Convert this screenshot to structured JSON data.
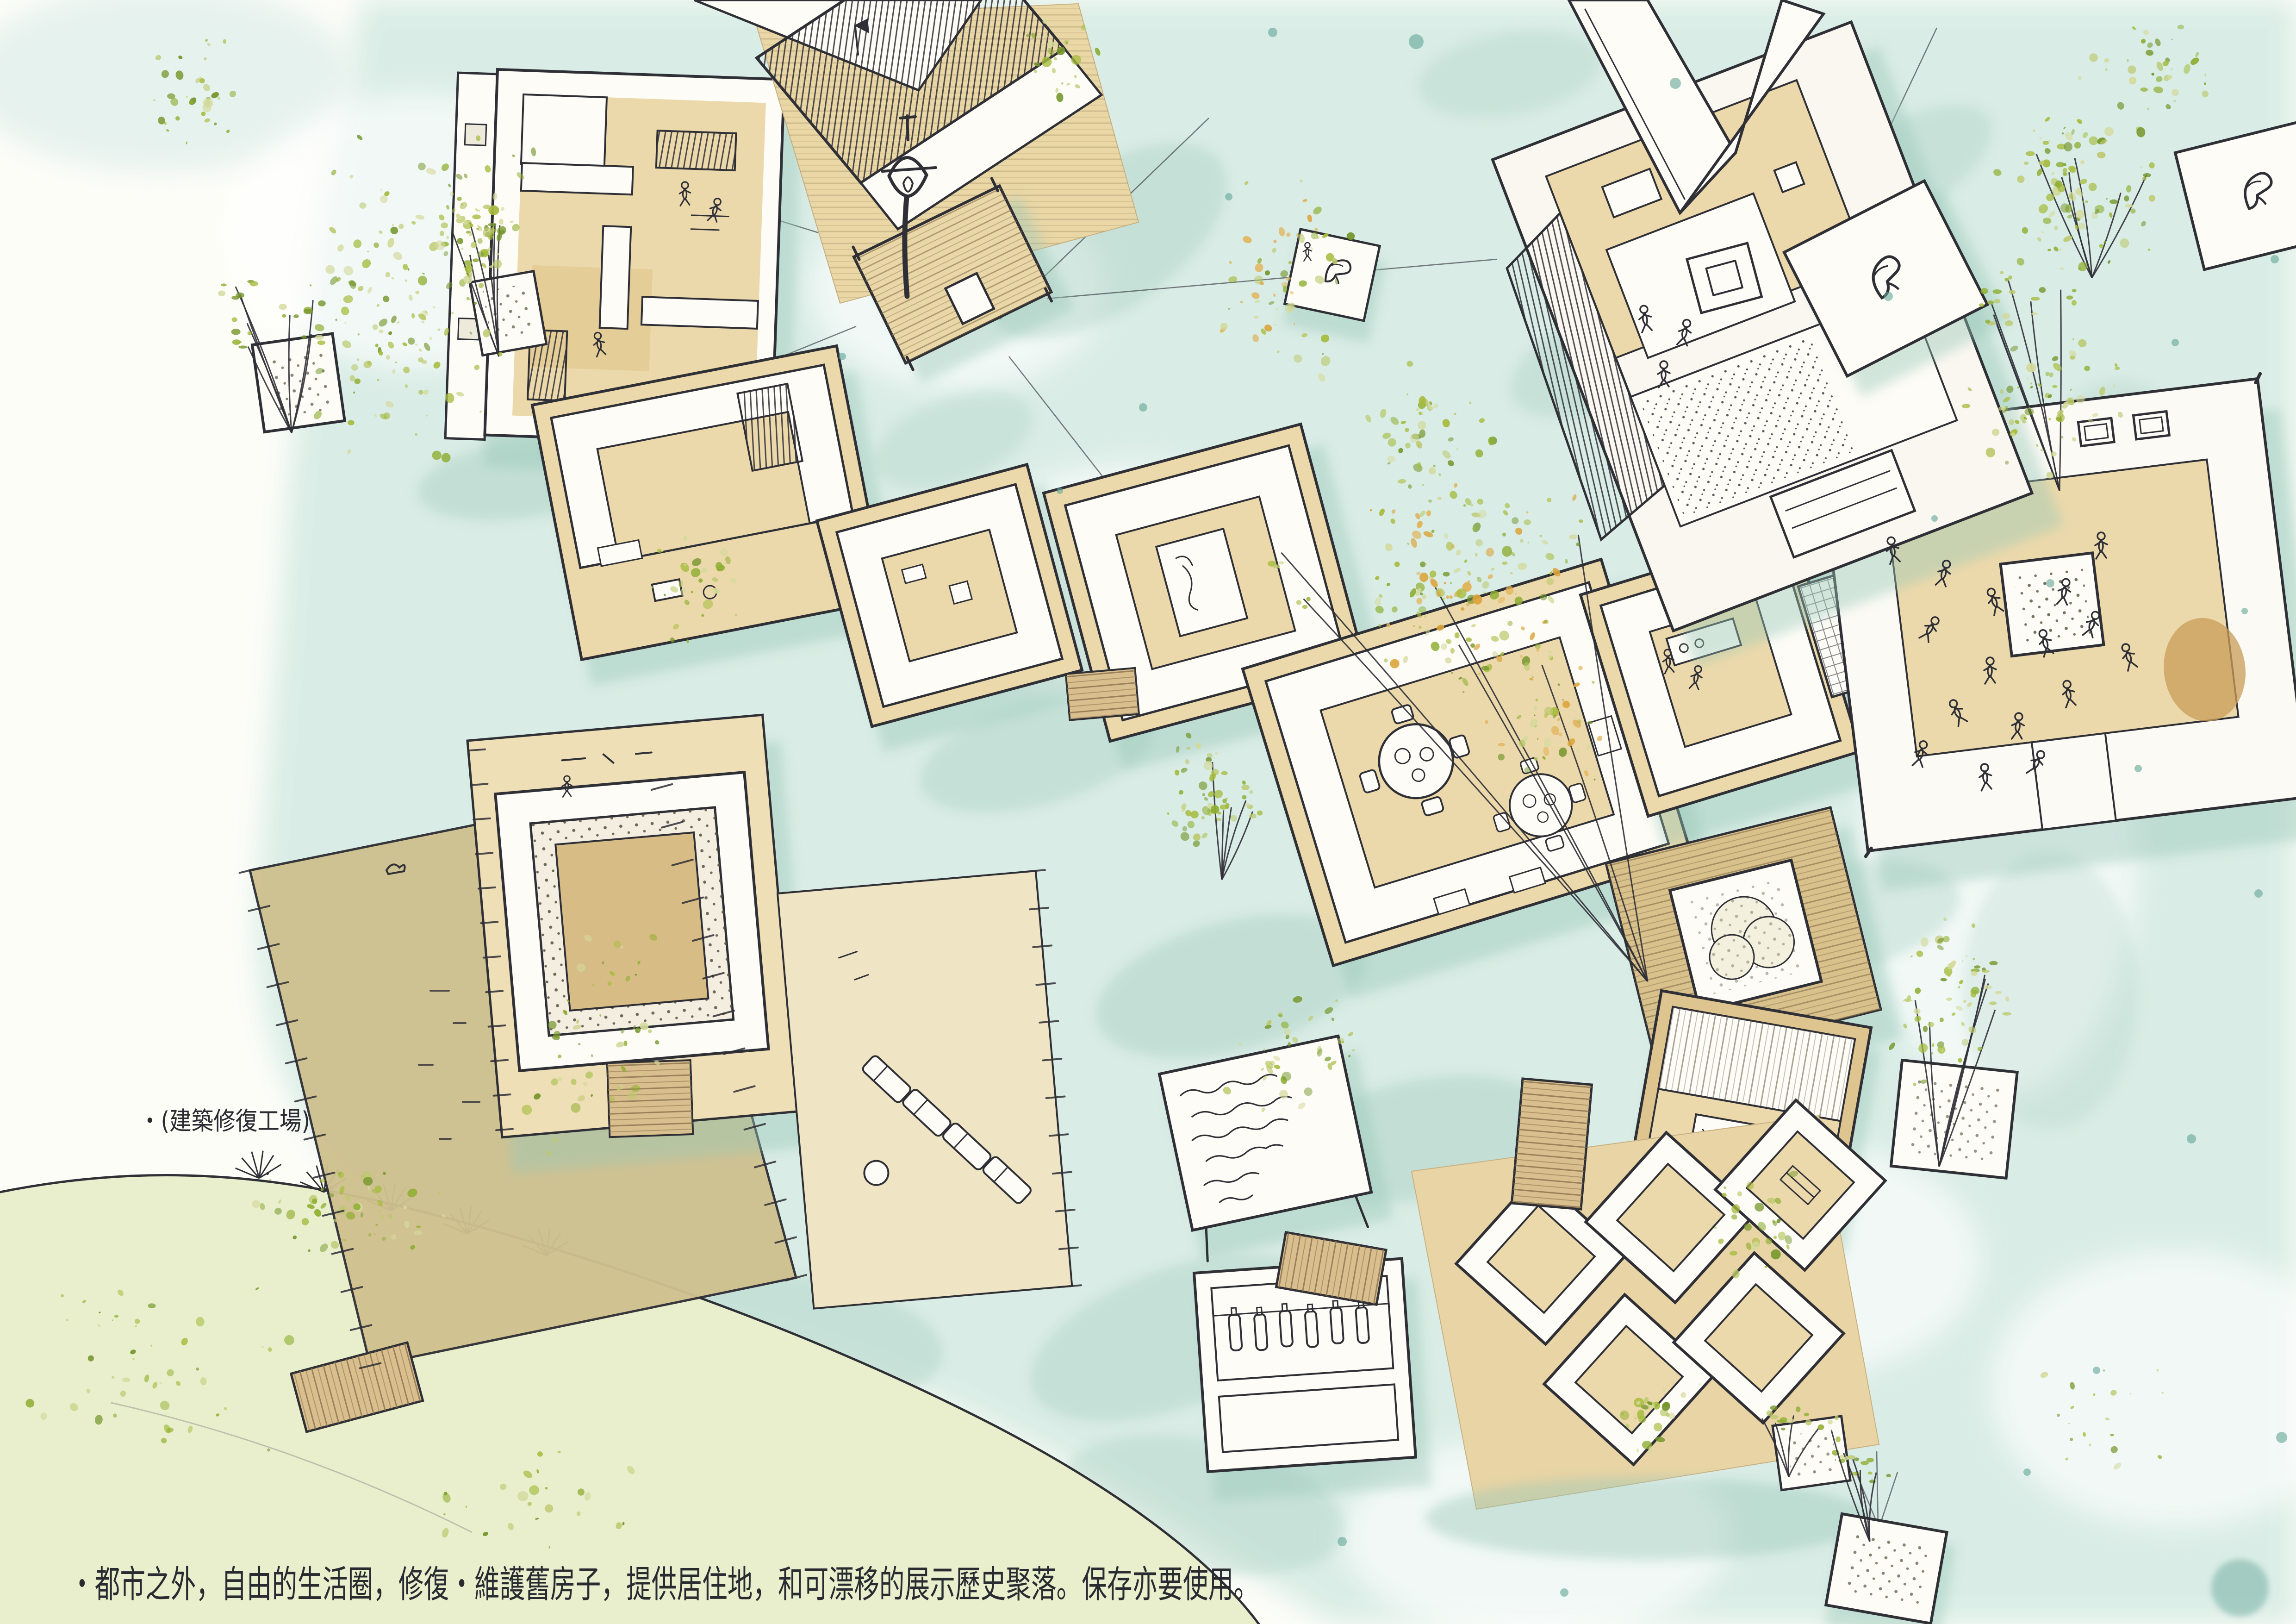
{
  "annotations": {
    "workshop_label": "・(建築修復工場)",
    "caption": "・都市之外，自由的生活圈，修復・維護舊房子，提供居住地，和可漂移的展示歷史聚落。保存亦要使用。"
  },
  "palette": {
    "paper": "#fdfdf8",
    "water_wash": "#d8ece5",
    "water_sage": "#aed3c6",
    "teal_accent": "#63a596",
    "hill_green": "#e9efcd",
    "leaf_green": "#a6bc3f",
    "orange_speckle": "#dba43c",
    "deck_tan": "#ecd9ab",
    "wood_brown": "#c89e63",
    "dock_khaki": "#cfc18f",
    "ink": "#2f2f36"
  },
  "scene": {
    "type": "hand-drawn watercolor axonometric site sketch",
    "features": [
      "floating courtyard houses on water",
      "restoration workshop dock",
      "lamp-mast raft with mooring lines",
      "plaza platform with dancing figures and tree planter",
      "stage house with band",
      "round-table courtyard",
      "zigzag room cluster with plank bridges",
      "floating tree planters",
      "grassy shore hill"
    ]
  }
}
